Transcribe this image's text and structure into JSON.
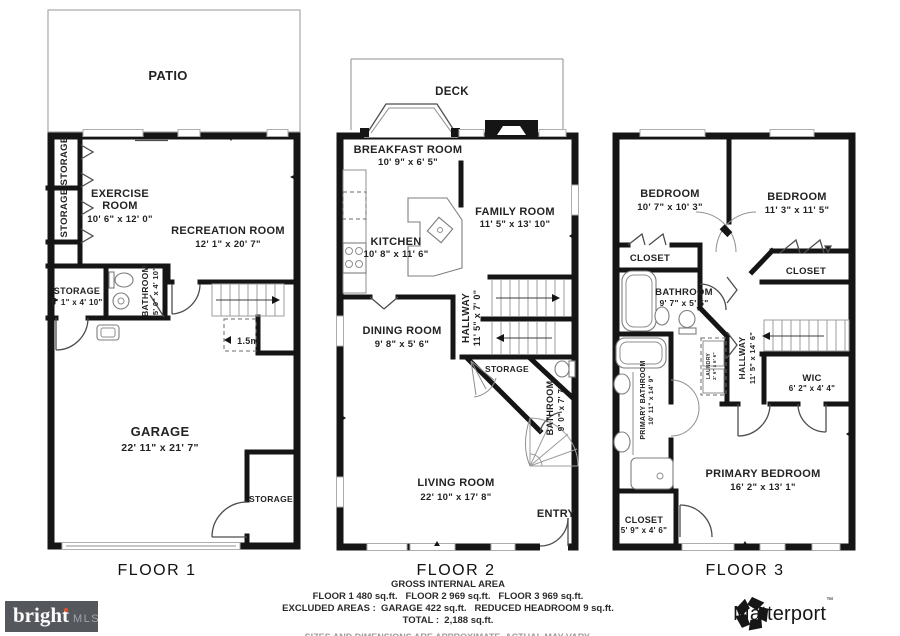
{
  "colors": {
    "wall": "#151515",
    "patio_border": "#a8a8a8",
    "disclaimer_gray": "#9c9c9c",
    "bright_bg": "#54585d",
    "bright_dot": "#e0532f",
    "matterport_black": "#161616"
  },
  "floors": {
    "floor1": {
      "title": "FLOOR 1",
      "patio": "PATIO",
      "storage_a": "STORAGE",
      "storage_b": "STORAGE",
      "exercise_line1": "EXERCISE",
      "exercise_line2": "ROOM",
      "exercise_dims": "10' 6\" x 12' 0\"",
      "recreation": "RECREATION ROOM",
      "recreation_dims": "12' 1\" x 20' 7\"",
      "storage_c": "STORAGE",
      "storage_c_dims": "5' 1\" x 4' 10\"",
      "bathroom": "BATHROOM",
      "bathroom_dims": "5' 0\" x 4' 10\"",
      "stair_note": "1.5m",
      "garage": "GARAGE",
      "garage_dims": "22' 11\" x 21' 7\"",
      "storage_d": "STORAGE"
    },
    "floor2": {
      "title": "FLOOR 2",
      "deck": "DECK",
      "breakfast": "BREAKFAST ROOM",
      "breakfast_dims": "10' 9\" x 6' 5\"",
      "kitchen": "KITCHEN",
      "kitchen_dims": "10' 8\" x 11' 6\"",
      "family": "FAMILY ROOM",
      "family_dims": "11' 5\" x 13' 10\"",
      "hallway": "HALLWAY",
      "hallway_dims": "11' 5\" x 7' 0\"",
      "dining": "DINING ROOM",
      "dining_dims": "9' 8\" x 5' 6\"",
      "storage": "STORAGE",
      "bathroom": "BATHROOM",
      "bathroom_dims": "9' 0\" x 7' 7\"",
      "living": "LIVING ROOM",
      "living_dims": "22' 10\" x 17' 8\"",
      "entry": "ENTRY"
    },
    "floor3": {
      "title": "FLOOR 3",
      "bedroom1": "BEDROOM",
      "bedroom1_dims": "10' 7\" x 10' 3\"",
      "bedroom2": "BEDROOM",
      "bedroom2_dims": "11' 3\" x 11' 5\"",
      "closet1": "CLOSET",
      "closet2": "CLOSET",
      "bathroom": "BATHROOM",
      "bathroom_dims": "9' 7\" x 5' 5\"",
      "primary_bath": "PRIMARY BATHROOM",
      "primary_bath_dims": "10' 11\" x 14' 9\"",
      "laundry": "LAUNDRY",
      "laundry_dims": "2' 6\" x 6' 6\"",
      "hallway": "HALLWAY",
      "hallway_dims": "11' 5\" x 14' 6\"",
      "wic": "WIC",
      "wic_dims": "6' 2\" x 4' 4\"",
      "primary_bedroom": "PRIMARY BEDROOM",
      "primary_bedroom_dims": "16' 2\" x 13' 1\"",
      "closet3": "CLOSET",
      "closet3_dims": "5' 9\" x 4' 6\""
    }
  },
  "footer": {
    "heading": "GROSS INTERNAL AREA",
    "floor_areas": "FLOOR 1 480 sq.ft.   FLOOR 2 969 sq.ft.   FLOOR 3 969 sq.ft.",
    "excluded": "EXCLUDED AREAS :  GARAGE 422 sq.ft.   REDUCED HEADROOM 9 sq.ft.",
    "total": "TOTAL :  2,188 sq.ft.",
    "disclaimer": "SIZES AND DIMENSIONS ARE APPROXIMATE, ACTUAL MAY VARY."
  },
  "brands": {
    "bright": {
      "name": "bright",
      "suffix": "MLS"
    },
    "matterport": {
      "name": "Matterport",
      "mark": "™"
    }
  }
}
